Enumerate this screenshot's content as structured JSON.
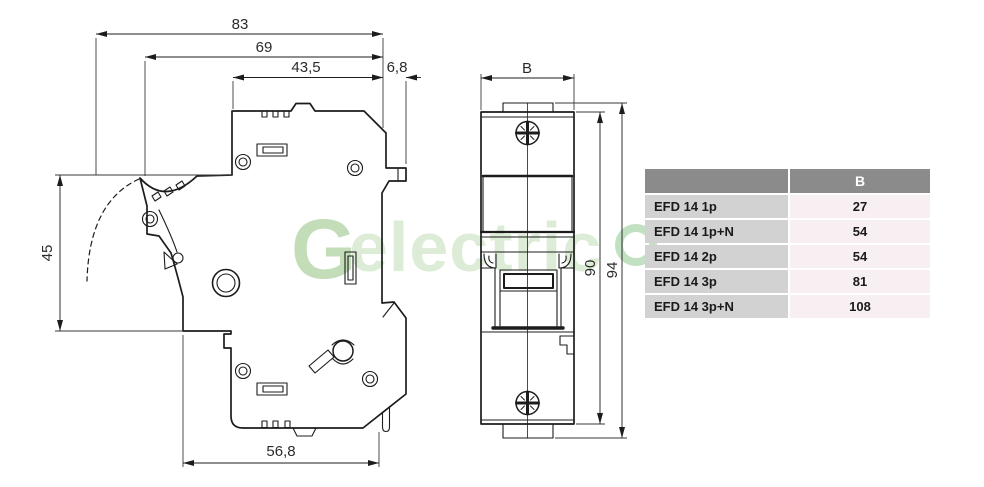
{
  "drawing": {
    "side_view": {
      "dim_total_width": "83",
      "dim_body_width": "69",
      "dim_front_width": "43,5",
      "dim_rail_catch": "6,8",
      "dim_lever_height": "45",
      "dim_base_width": "56,8"
    },
    "front_view": {
      "dim_width_label": "B",
      "dim_body_height": "90",
      "dim_total_height": "94"
    },
    "line_color": "#1c1c1c"
  },
  "table": {
    "header": {
      "model": "",
      "b": "B"
    },
    "rows": [
      {
        "model": "EFD 14 1p",
        "b": "27"
      },
      {
        "model": "EFD 14 1p+N",
        "b": "54"
      },
      {
        "model": "EFD 14 2p",
        "b": "54"
      },
      {
        "model": "EFD 14 3p",
        "b": "81"
      },
      {
        "model": "EFD 14 3p+N",
        "b": "108"
      }
    ],
    "colors": {
      "header_bg": "#8b8b8b",
      "header_text": "#ffffff",
      "model_col_bg": "#d2d2d2",
      "value_col_bg": "#f8eff2",
      "text": "#1a1a1a"
    }
  },
  "watermark": {
    "logo": "G",
    "text": "electric",
    "logo_color": "#c3ddb9",
    "text_color": "#ddecd6",
    "ring_color": "#90c890"
  }
}
